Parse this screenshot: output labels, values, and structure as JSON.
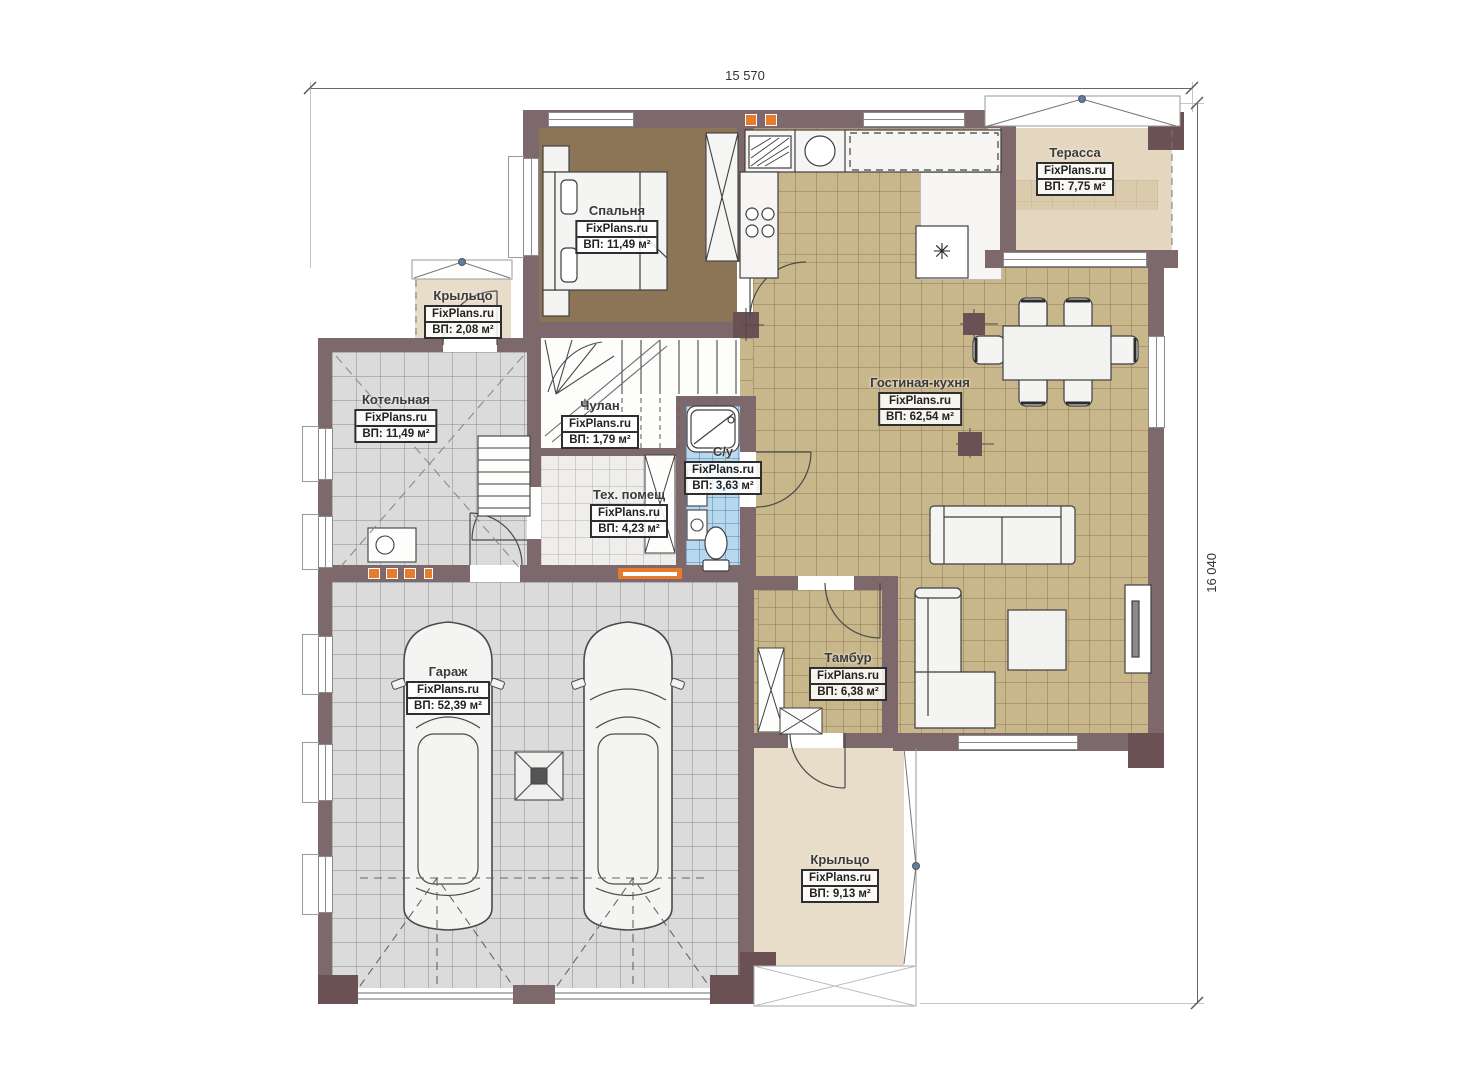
{
  "plan": {
    "brand": "FixPlans.ru",
    "dimensions": {
      "width_label": "15 570",
      "height_label": "16 040"
    },
    "rooms": [
      {
        "key": "bedroom",
        "name": "Спальня",
        "brand": "FixPlans.ru",
        "area": "ВП: 11,49 м²"
      },
      {
        "key": "terrace",
        "name": "Терасса",
        "brand": "FixPlans.ru",
        "area": "ВП: 7,75 м²"
      },
      {
        "key": "porch-left",
        "name": "Крыльцо",
        "brand": "FixPlans.ru",
        "area": "ВП: 2,08 м²"
      },
      {
        "key": "boiler",
        "name": "Котельная",
        "brand": "FixPlans.ru",
        "area": "ВП: 11,49 м²"
      },
      {
        "key": "closet",
        "name": "Чулан",
        "brand": "FixPlans.ru",
        "area": "ВП: 1,79 м²"
      },
      {
        "key": "bathroom",
        "name": "С/у",
        "brand": "FixPlans.ru",
        "area": "ВП: 3,63 м²"
      },
      {
        "key": "tech",
        "name": "Тех. помещ",
        "brand": "FixPlans.ru",
        "area": "ВП: 4,23 м²"
      },
      {
        "key": "living-kitchen",
        "name": "Гостиная-кухня",
        "brand": "FixPlans.ru",
        "area": "ВП: 62,54 м²"
      },
      {
        "key": "garage",
        "name": "Гараж",
        "brand": "FixPlans.ru",
        "area": "ВП: 52,39 м²"
      },
      {
        "key": "vestibule",
        "name": "Тамбур",
        "brand": "FixPlans.ru",
        "area": "ВП: 6,38 м²"
      },
      {
        "key": "porch-main",
        "name": "Крыльцо",
        "brand": "FixPlans.ru",
        "area": "ВП: 9,13 м²"
      }
    ],
    "symbols": {
      "fireplace_glyph": "✳"
    },
    "colors": {
      "wall": "#7d686b",
      "column": "#6c5154",
      "floor_living": "#c9b78c",
      "floor_bedroom": "#8c7456",
      "floor_garage": "#dbdbdb",
      "floor_bath": "#b7d8ef",
      "floor_terrace": "#e4d7c0",
      "floor_porch": "#e8ddc9",
      "accent_orange": "#e87a2b"
    }
  }
}
